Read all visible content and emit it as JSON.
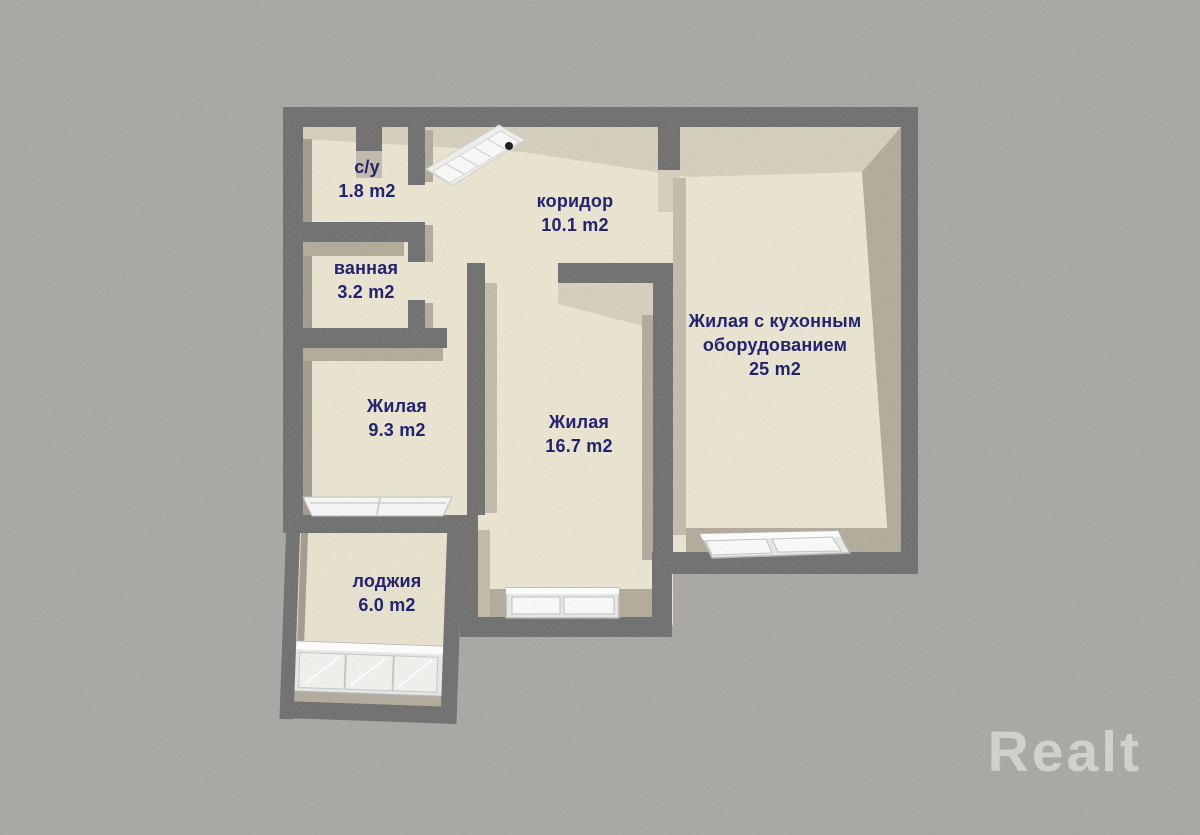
{
  "watermark": "Realt",
  "rooms": [
    {
      "id": "wc",
      "name": "с/у",
      "area": "1.8 m2"
    },
    {
      "id": "bathroom",
      "name": "ванная",
      "area": "3.2 m2"
    },
    {
      "id": "corridor",
      "name": "коридор",
      "area": "10.1 m2"
    },
    {
      "id": "living-9",
      "name": "Жилая",
      "area": "9.3 m2"
    },
    {
      "id": "living-16",
      "name": "Жилая",
      "area": "16.7 m2"
    },
    {
      "id": "living-kitchen",
      "name_lines": [
        "Жилая с кухонным",
        "оборудованием"
      ],
      "area": "25 m2"
    },
    {
      "id": "loggia",
      "name": "лоджия",
      "area": "6.0 m2"
    }
  ],
  "colors": {
    "background": "#a7a7a3",
    "wall_top": "#6e6e6e",
    "wall_face_light": "#d6cfbe",
    "wall_face": "#b2aa99",
    "floor": "#ece5d2",
    "label_text": "#23236e",
    "window_white": "#fbfbfa",
    "watermark": "#d8d8d4"
  }
}
